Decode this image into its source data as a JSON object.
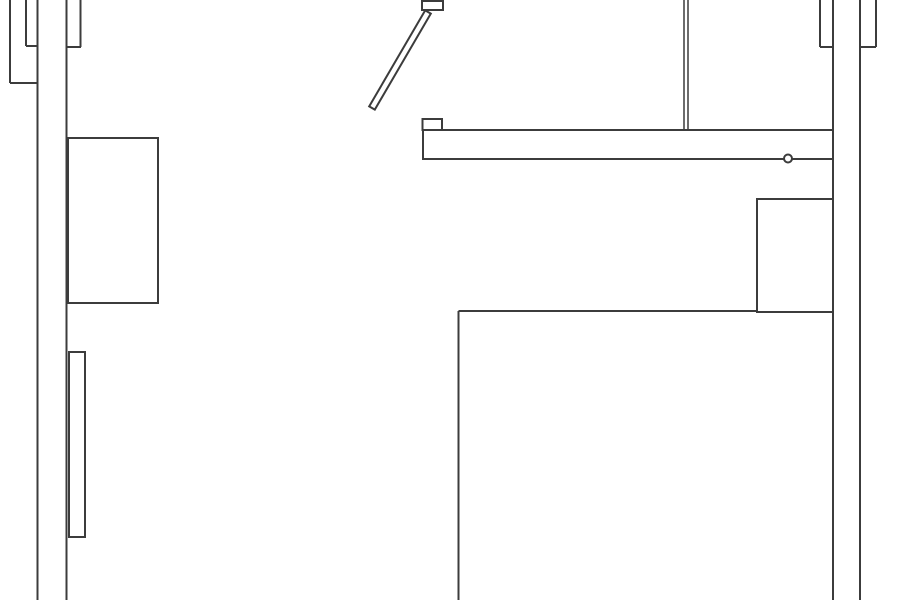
{
  "canvas": {
    "width": 900,
    "height": 600,
    "background_color": "#ffffff",
    "line_color": "#3c3c3c",
    "line_width": 2
  },
  "floor_plan": {
    "shapes": [
      {
        "name": "left-outer-wall-line",
        "type": "line",
        "x1": 37.5,
        "y1": 0,
        "x2": 37.5,
        "y2": 600
      },
      {
        "name": "left-inner-wall-line",
        "type": "line",
        "x1": 66.5,
        "y1": 0,
        "x2": 66.5,
        "y2": 600
      },
      {
        "name": "left-edge-stub-line",
        "type": "line",
        "x1": 10,
        "y1": 0,
        "x2": 10,
        "y2": 83
      },
      {
        "name": "left-edge-stub-cap",
        "type": "line",
        "x1": 10,
        "y1": 83,
        "x2": 37.5,
        "y2": 83
      },
      {
        "name": "left-upper-stub-line",
        "type": "line",
        "x1": 26,
        "y1": 0,
        "x2": 26,
        "y2": 46
      },
      {
        "name": "left-upper-stub-cap",
        "type": "line",
        "x1": 26,
        "y1": 46,
        "x2": 38,
        "y2": 46
      },
      {
        "name": "left-inner-stub-line",
        "type": "line",
        "x1": 80.5,
        "y1": 0,
        "x2": 80.5,
        "y2": 47
      },
      {
        "name": "left-inner-stub-cap",
        "type": "line",
        "x1": 66.5,
        "y1": 47,
        "x2": 81,
        "y2": 47
      },
      {
        "name": "right-inner-wall-line",
        "type": "line",
        "x1": 833,
        "y1": 0,
        "x2": 833,
        "y2": 600
      },
      {
        "name": "right-outer-wall-line",
        "type": "line",
        "x1": 860,
        "y1": 0,
        "x2": 860,
        "y2": 600
      },
      {
        "name": "right-upper-stub-line",
        "type": "line",
        "x1": 820,
        "y1": 0,
        "x2": 820,
        "y2": 47
      },
      {
        "name": "right-upper-stub-cap",
        "type": "line",
        "x1": 820,
        "y1": 47,
        "x2": 833,
        "y2": 47
      },
      {
        "name": "right-edge-stub-line",
        "type": "line",
        "x1": 876,
        "y1": 0,
        "x2": 876,
        "y2": 47
      },
      {
        "name": "right-edge-stub-cap",
        "type": "line",
        "x1": 860,
        "y1": 47,
        "x2": 876,
        "y2": 47
      },
      {
        "name": "partition-wall-line-left",
        "type": "line",
        "x1": 684,
        "y1": 0,
        "x2": 684,
        "y2": 130,
        "width": 1.5
      },
      {
        "name": "partition-wall-line-right",
        "type": "line",
        "x1": 688,
        "y1": 0,
        "x2": 688,
        "y2": 130,
        "width": 1.5
      },
      {
        "name": "large-room-left-edge",
        "type": "line",
        "x1": 458.5,
        "y1": 311,
        "x2": 458.5,
        "y2": 600
      },
      {
        "name": "large-room-top-edge",
        "type": "line",
        "x1": 458.5,
        "y1": 311,
        "x2": 833,
        "y2": 311
      },
      {
        "name": "upper-door-jamb",
        "type": "rect",
        "x": 422,
        "y": 1,
        "w": 21,
        "h": 9
      },
      {
        "name": "lower-door-jamb",
        "type": "rect",
        "x": 422.5,
        "y": 119,
        "w": 19.5,
        "h": 11
      },
      {
        "name": "counter-bar",
        "type": "rect",
        "x": 423,
        "y": 130,
        "w": 410,
        "h": 29
      },
      {
        "name": "left-cabinet",
        "type": "rect",
        "x": 68,
        "y": 138,
        "w": 90,
        "h": 165
      },
      {
        "name": "left-thin-fixture",
        "type": "rect",
        "x": 69,
        "y": 352,
        "w": 16,
        "h": 185
      },
      {
        "name": "right-cabinet",
        "type": "rect",
        "x": 757,
        "y": 199,
        "w": 76,
        "h": 113
      },
      {
        "name": "door-leaf",
        "type": "polygon",
        "points": "430.8,13.6 425.2,10.4 369.2,106.4 374.8,109.6"
      },
      {
        "name": "knob-circle",
        "type": "circle",
        "cx": 788,
        "cy": 158.5,
        "r": 4
      }
    ]
  }
}
